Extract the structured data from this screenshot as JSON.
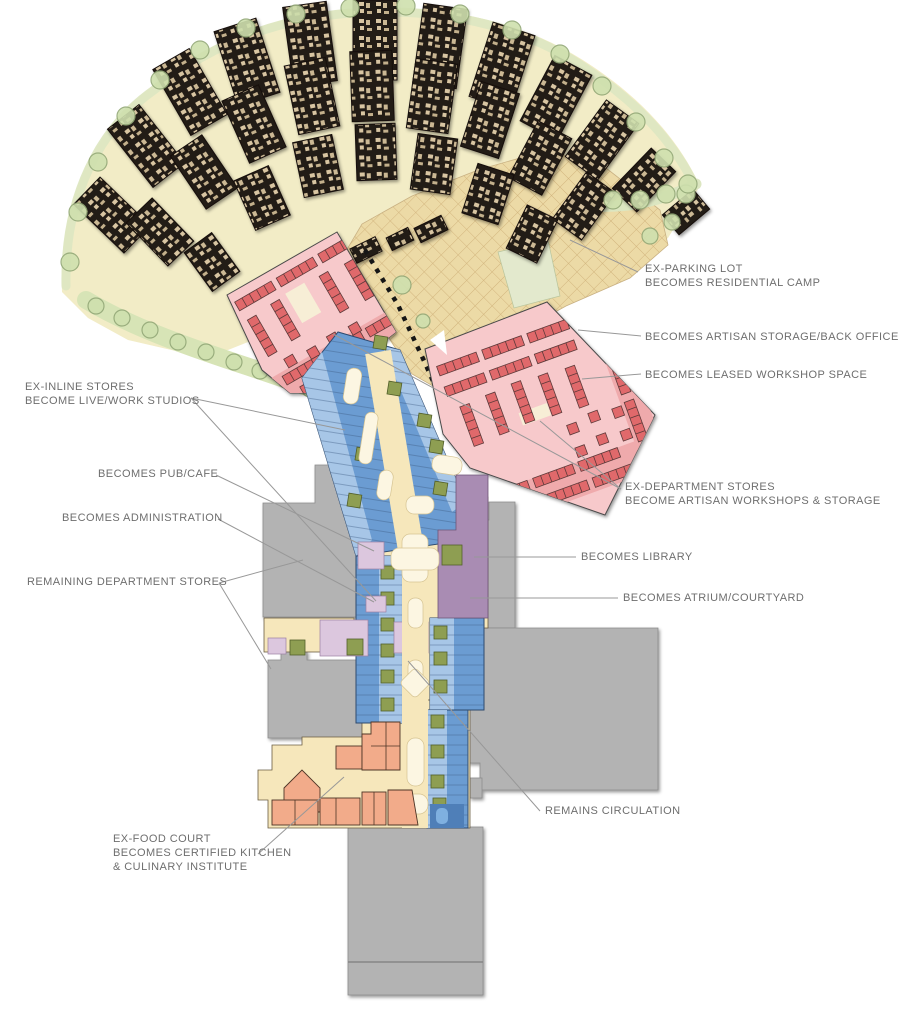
{
  "diagram": {
    "type": "mall-adaptive-reuse-site-plan",
    "labels": {
      "ex_parking": {
        "line1": "EX-PARKING LOT",
        "line2": "BECOMES RESIDENTIAL CAMP"
      },
      "artisan_storage": {
        "line1": "BECOMES ARTISAN STORAGE/BACK OFFICE"
      },
      "leased_workshop": {
        "line1": "BECOMES LEASED WORKSHOP SPACE"
      },
      "ex_inline": {
        "line1": "EX-INLINE STORES",
        "line2": "BECOME LIVE/WORK STUDIOS"
      },
      "pub_cafe": {
        "line1": "BECOMES PUB/CAFE"
      },
      "administration": {
        "line1": "BECOMES ADMINISTRATION"
      },
      "remaining_dept": {
        "line1": "REMAINING DEPARTMENT STORES"
      },
      "ex_department": {
        "line1": "EX-DEPARTMENT STORES",
        "line2": "BECOME ARTISAN WORKSHOPS & STORAGE"
      },
      "library": {
        "line1": "BECOMES LIBRARY"
      },
      "atrium": {
        "line1": "BECOMES ATRIUM/COURTYARD"
      },
      "circulation": {
        "line1": "REMAINS CIRCULATION"
      },
      "ex_food": {
        "line1": "EX-FOOD COURT",
        "line2": "BECOMES CERTIFIED KITCHEN",
        "line3": "& CULINARY INSTITUTE"
      }
    },
    "colors": {
      "residential_ground": "#f2ecc6",
      "parking_hatch": "#ecdaa6",
      "workshop_pink": "#f7c9cb",
      "workshop_red_marks": "#e0696b",
      "studio_blue": "#6b9cd2",
      "studio_light_blue": "#aecbe9",
      "mall_cream": "#f6e7bb",
      "library_purple": "#a98cb3",
      "admin_lavender": "#dcc7de",
      "dept_store_grey": "#b3b3b3",
      "food_court_orange": "#f2ab8a",
      "green_space": "#cfe0ae",
      "label_text": "#6e6e6e"
    }
  }
}
